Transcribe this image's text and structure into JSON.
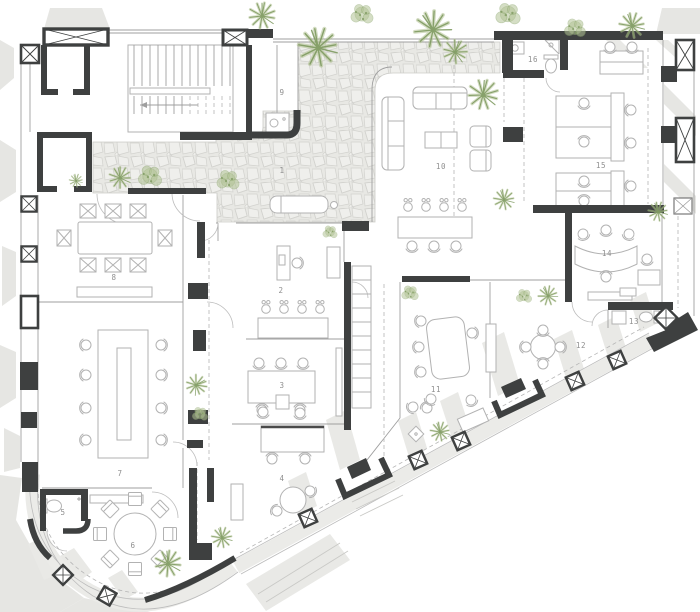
{
  "plan": {
    "rooms": [
      {
        "label": "1"
      },
      {
        "label": "2"
      },
      {
        "label": "3"
      },
      {
        "label": "4"
      },
      {
        "label": "5"
      },
      {
        "label": "6"
      },
      {
        "label": "7"
      },
      {
        "label": "8"
      },
      {
        "label": "9"
      },
      {
        "label": "10"
      },
      {
        "label": "11"
      },
      {
        "label": "12"
      },
      {
        "label": "13"
      },
      {
        "label": "14"
      },
      {
        "label": "15"
      },
      {
        "label": "16"
      }
    ],
    "palette": {
      "wall": "#3e4040",
      "thin_line": "#9f9f9f",
      "furniture": "#b2b2b2",
      "stone_fill": "#e8e8e4",
      "stone_joint": "#d2d2ce",
      "shadow": "#e6e6e3",
      "plant_light": "#aec08f",
      "plant_dark": "#7e9a60",
      "label_text": "#8f8f8f",
      "background": "#ffffff"
    }
  }
}
